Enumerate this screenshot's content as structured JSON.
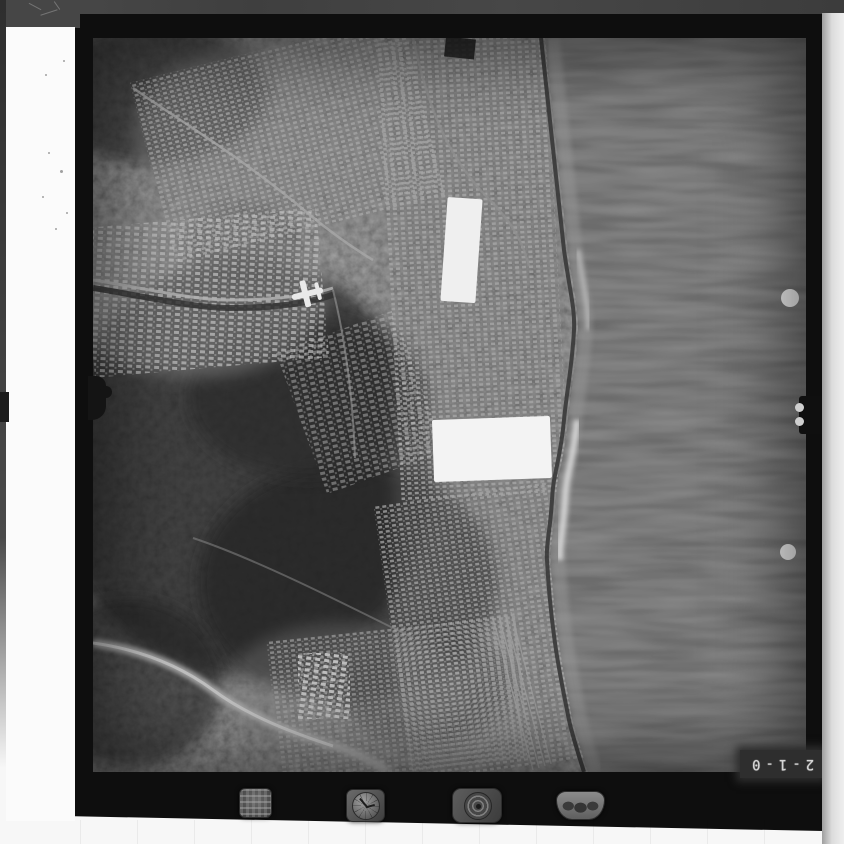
{
  "film_frame": {
    "frame_number": "2-1-0",
    "frame_number_orientation": "rotated-180",
    "subject": "black-and-white aerial reconnaissance photograph of a coastal city: dark wooded hills left, dense urban grid along shoreline, dark sea on the right",
    "notable_marks": {
      "white_cloud_patches": 2,
      "white_registration_dots": 2,
      "edge_fiducial_notches": [
        "left-center",
        "right-center"
      ]
    }
  },
  "instrument_strip": {
    "icons": [
      "data-plate",
      "clock-dial",
      "altimeter-dial",
      "level-indicator"
    ]
  },
  "colors": {
    "film_border": "#0e0e0e",
    "scan_margin": "#f7f7f7",
    "left_leader_strip": "#fbfbfb",
    "sea": "#242424",
    "land_base": "#4e4e4e",
    "city_highlight": "#c2c2c2",
    "frame_number_text": "#d6d6d6"
  }
}
